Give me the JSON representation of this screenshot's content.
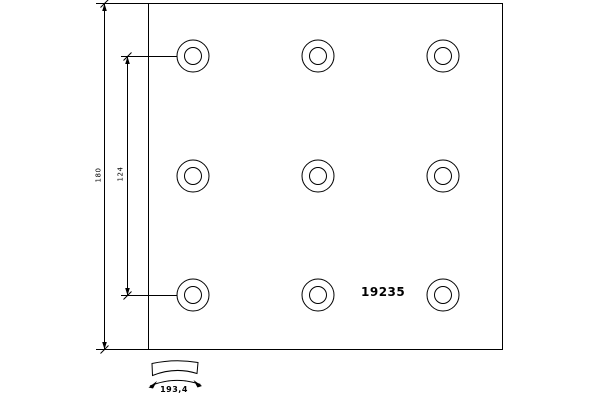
{
  "drawing": {
    "part_number": "19235",
    "dimensions": {
      "height": "180",
      "hole_spacing": "124",
      "arc_width": "193,4"
    },
    "hole_grid": {
      "rows_y": [
        56,
        176,
        295
      ],
      "cols_x": [
        193,
        318,
        443
      ],
      "outer_radius": 16,
      "inner_radius": 8.5
    },
    "plate": {
      "x": 148.5,
      "y": 3.5,
      "width": 354,
      "height": 346
    },
    "colors": {
      "line": "#000000",
      "background": "#ffffff"
    }
  }
}
